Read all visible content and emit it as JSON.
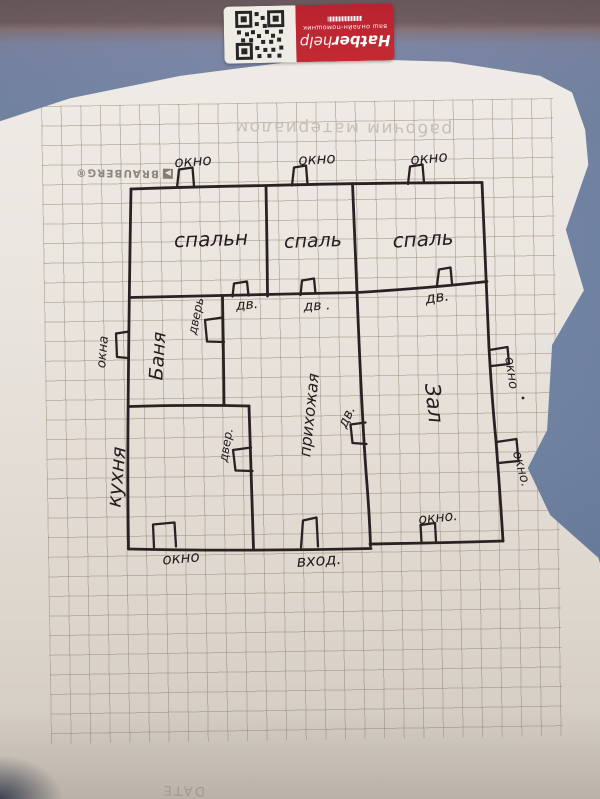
{
  "sticker": {
    "brand_bold": "Hatber",
    "brand_light": "help",
    "tagline": "ваш онлайн-помощник"
  },
  "notebook": {
    "top_print": "рабочим материалом",
    "brand": "BRAUBERG®",
    "footer": "DATE"
  },
  "labels": {
    "win_top_1": "окно",
    "win_top_2": "окно",
    "win_top_3": "окно",
    "bed1": "спальн",
    "bed2": "спаль",
    "bed3": "спаль",
    "dv1": "дв.",
    "dv2": "дв .",
    "dv3": "дв.",
    "door_banya": "дверь",
    "banya": "Баня",
    "win_left": "окна",
    "hallway": "прихожая",
    "zal": "Зал",
    "win_right_1": "окно",
    "win_right_2": "окно.",
    "kitchen": "кухня",
    "door_kitchen": "двер.",
    "dv_hall": "дв.",
    "win_bottom_left": "окно",
    "entrance": "вход.",
    "win_bottom_right": "окно."
  },
  "ink": "#2a2125"
}
